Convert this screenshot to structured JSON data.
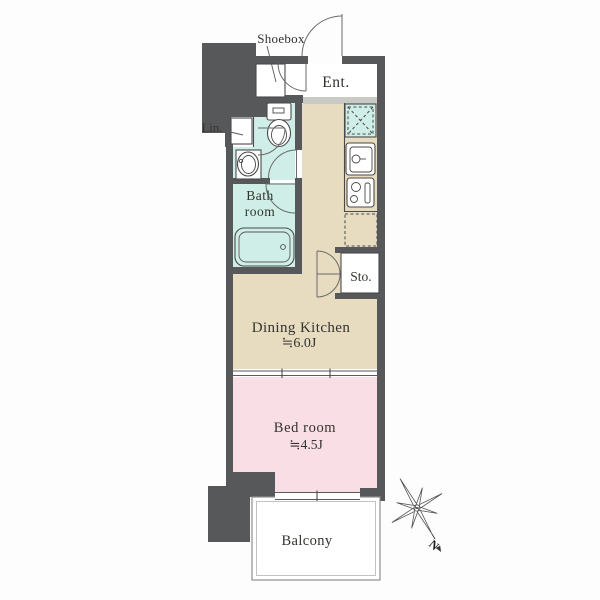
{
  "floor_plan": {
    "rooms": {
      "shoebox": {
        "label": "Shoebox"
      },
      "entrance": {
        "label": "Ent."
      },
      "linen": {
        "label": "Lin."
      },
      "bathroom": {
        "label_line1": "Bath",
        "label_line2": "room"
      },
      "storage": {
        "label": "Sto."
      },
      "dining_kitchen": {
        "label": "Dining Kitchen",
        "size": "≒6.0J"
      },
      "bedroom": {
        "label": "Bed room",
        "size": "≒4.5J"
      },
      "balcony": {
        "label": "Balcony"
      }
    },
    "compass": {
      "north_label": "N"
    },
    "colors": {
      "wall": "#57585a",
      "dining_kitchen_floor": "#e8dcc0",
      "bedroom_floor": "#fadee5",
      "wet_area_floor": "#cfeee7",
      "entrance_step": "#c9c9c5",
      "balcony_floor": "#ffffff",
      "outline": "#4a4a4a",
      "text": "#33332e"
    }
  }
}
